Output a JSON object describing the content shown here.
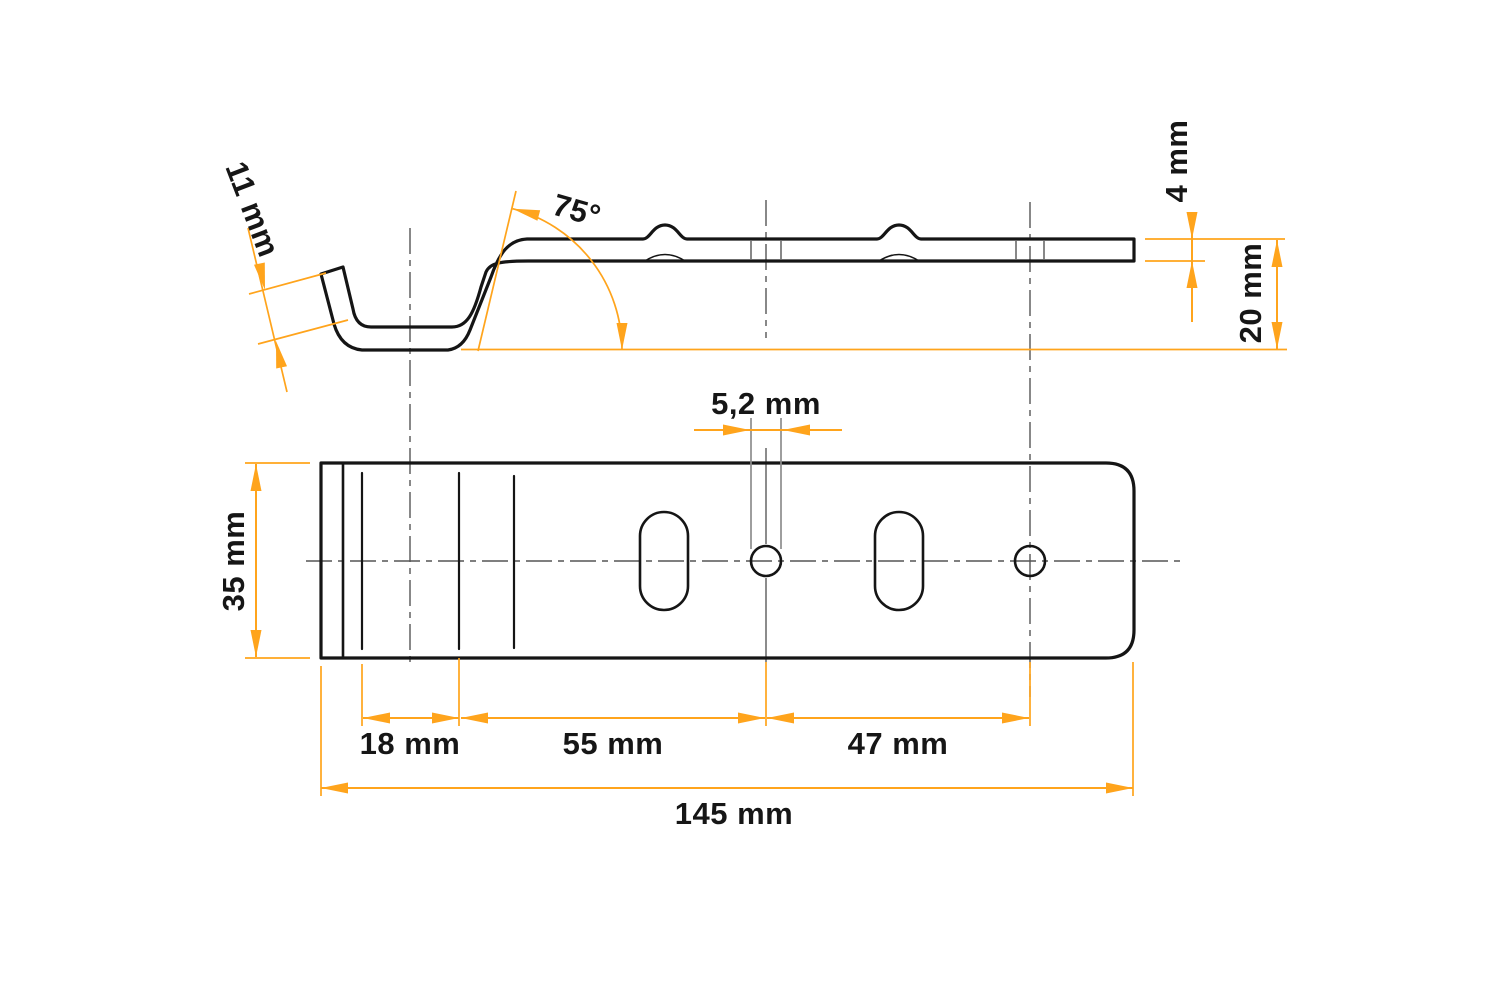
{
  "drawing": {
    "dimensions": {
      "lip_length": "11 mm",
      "bend_angle": "75°",
      "material_thickness": "4 mm",
      "hook_height": "20 mm",
      "hole_diameter": "5,2 mm",
      "plate_width": "35 mm",
      "first_bend_length": "18 mm",
      "bend_to_hole": "55 mm",
      "hole_to_hole": "47 mm",
      "overall_length": "145 mm"
    },
    "colors": {
      "accent": "#FFA41C",
      "outline": "#151515",
      "centerline": "#555555",
      "extension_gray": "#8d8d8d",
      "text": "#161616",
      "background": "#ffffff"
    }
  }
}
